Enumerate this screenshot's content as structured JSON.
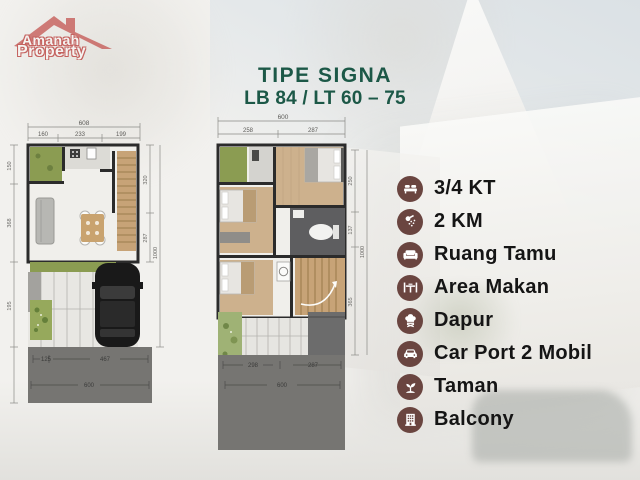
{
  "logo": {
    "line1": "Amanah",
    "line2": "Property"
  },
  "title": {
    "line1": "TIPE SIGNA",
    "line2": "LB 84 / LT 60 – 75"
  },
  "colors": {
    "title_green": "#1c5847",
    "icon_maroon": "#6a4540",
    "logo_red": "#c35350",
    "plan_green": "#8b9c52",
    "wood": "#c7a377",
    "road_gray": "#767572"
  },
  "plan_ground": {
    "dim_total_width": "608",
    "dim_segments_top": [
      "160",
      "233",
      "199"
    ],
    "dim_bottom": [
      "125",
      "467"
    ],
    "dim_bottom_total": "600",
    "dim_right": [
      "320",
      "287"
    ],
    "dim_right_total": "1000",
    "dim_left": [
      "150",
      "368",
      "195"
    ]
  },
  "plan_upper": {
    "dim_total_width": "600",
    "dim_segments_top": [
      "258",
      "287"
    ],
    "dim_bottom": [
      "298",
      "287"
    ],
    "dim_bottom_total": "600",
    "dim_right": [
      "250",
      "137",
      "365"
    ],
    "dim_right_total": "1000"
  },
  "features": [
    {
      "icon": "bed-icon",
      "label": "3/4 KT"
    },
    {
      "icon": "shower-icon",
      "label": "2 KM"
    },
    {
      "icon": "sofa-icon",
      "label": "Ruang Tamu"
    },
    {
      "icon": "dining-icon",
      "label": "Area Makan"
    },
    {
      "icon": "kitchen-icon",
      "label": "Dapur"
    },
    {
      "icon": "car-icon",
      "label": "Car Port 2 Mobil"
    },
    {
      "icon": "plant-icon",
      "label": "Taman"
    },
    {
      "icon": "building-icon",
      "label": "Balcony"
    }
  ]
}
